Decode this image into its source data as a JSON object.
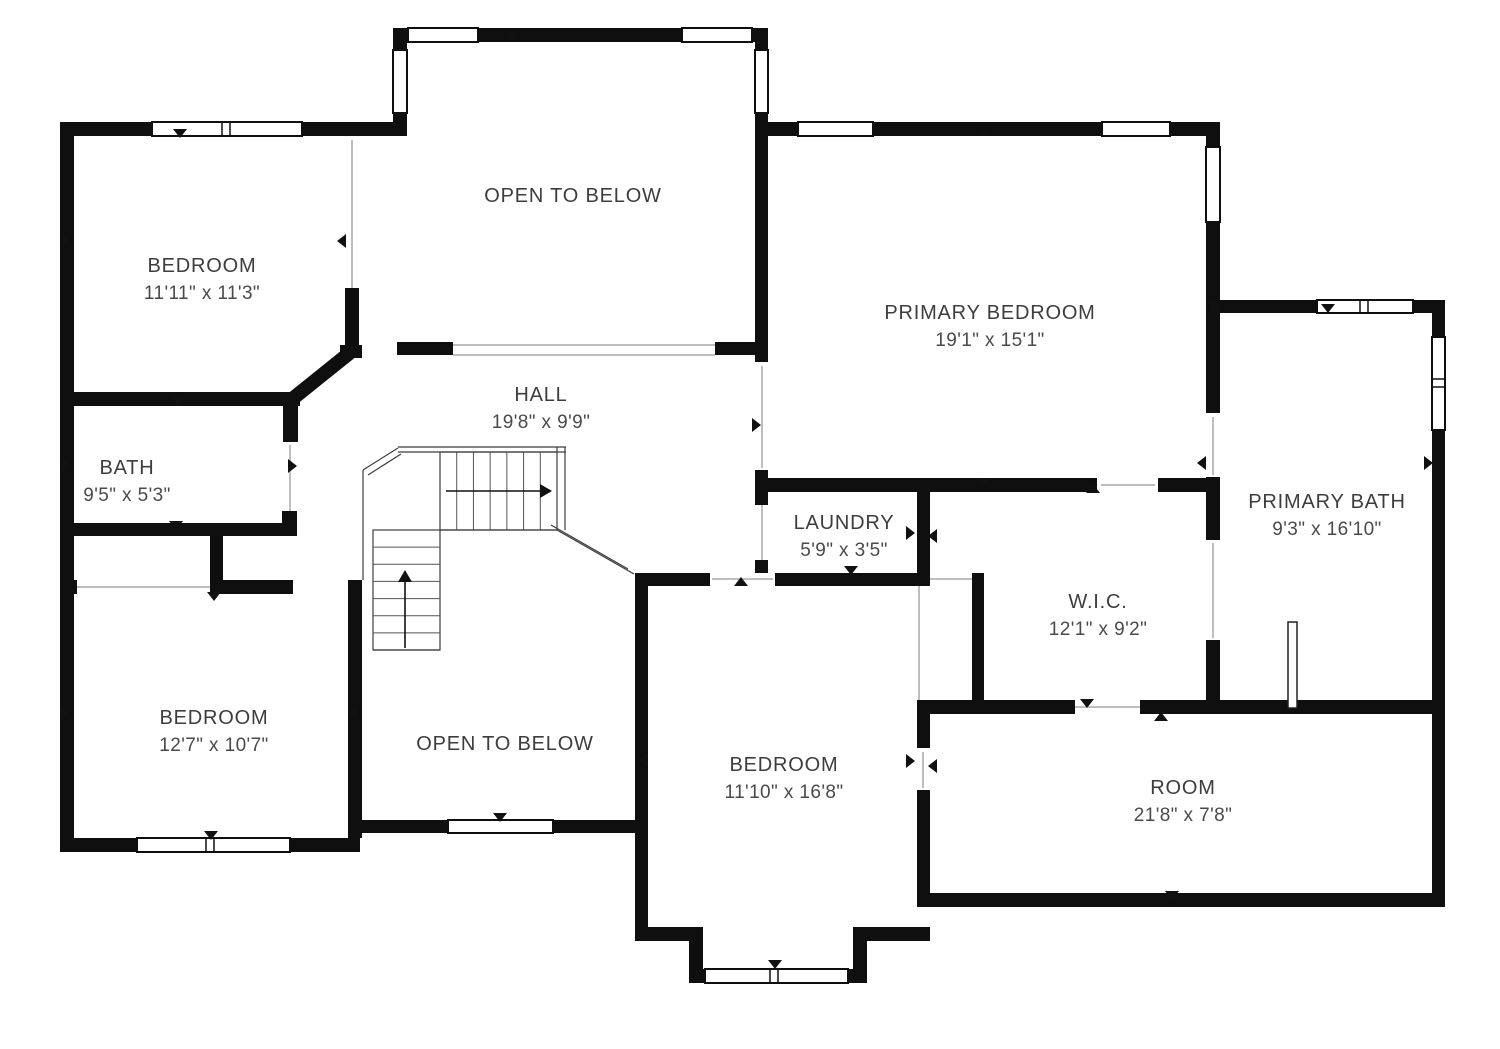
{
  "type": "floor-plan",
  "title": "Second floor plan",
  "colors": {
    "background": "#ffffff",
    "wall": "#0f0f0f",
    "opening_line": "#a8a8a8",
    "stair_line": "#3c3c3c",
    "tread_line": "#555555",
    "text": "#3d3d3d"
  },
  "canvas": {
    "width": 1500,
    "height": 1049
  },
  "rooms": [
    {
      "id": "bedroom-top-left",
      "name": "BEDROOM",
      "dims": "11'11\" x 11'3\"",
      "x": 202,
      "y": 272
    },
    {
      "id": "open-to-below-top",
      "name": "OPEN TO BELOW",
      "dims": "",
      "x": 573,
      "y": 202
    },
    {
      "id": "primary-bedroom",
      "name": "PRIMARY BEDROOM",
      "dims": "19'1\" x 15'1\"",
      "x": 990,
      "y": 319
    },
    {
      "id": "hall",
      "name": "HALL",
      "dims": "19'8\" x 9'9\"",
      "x": 541,
      "y": 401
    },
    {
      "id": "bath",
      "name": "BATH",
      "dims": "9'5\" x 5'3\"",
      "x": 127,
      "y": 474
    },
    {
      "id": "laundry",
      "name": "LAUNDRY",
      "dims": "5'9\" x 3'5\"",
      "x": 844,
      "y": 529
    },
    {
      "id": "primary-bath",
      "name": "PRIMARY BATH",
      "dims": "9'3\" x 16'10\"",
      "x": 1327,
      "y": 508
    },
    {
      "id": "wic",
      "name": "W.I.C.",
      "dims": "12'1\" x 9'2\"",
      "x": 1098,
      "y": 608
    },
    {
      "id": "bedroom-bottom-left",
      "name": "BEDROOM",
      "dims": "12'7\" x 10'7\"",
      "x": 214,
      "y": 724
    },
    {
      "id": "open-to-below-bottom",
      "name": "OPEN TO BELOW",
      "dims": "",
      "x": 505,
      "y": 750
    },
    {
      "id": "bedroom-bottom-middle",
      "name": "BEDROOM",
      "dims": "11'10\" x 16'8\"",
      "x": 784,
      "y": 771
    },
    {
      "id": "room-bonus",
      "name": "ROOM",
      "dims": "21'8\" x 7'8\"",
      "x": 1183,
      "y": 794
    }
  ],
  "walls": [
    [
      60,
      122,
      345,
      14
    ],
    [
      60,
      122,
      14,
      730
    ],
    [
      393,
      28,
      375,
      14
    ],
    [
      393,
      28,
      14,
      108
    ],
    [
      755,
      28,
      13,
      108
    ],
    [
      755,
      122,
      465,
      14
    ],
    [
      1206,
      122,
      14,
      192
    ],
    [
      1220,
      300,
      225,
      13
    ],
    [
      1432,
      300,
      13,
      607
    ],
    [
      345,
      288,
      14,
      70
    ],
    [
      340,
      345,
      22,
      13
    ],
    [
      397,
      342,
      56,
      13
    ],
    [
      715,
      342,
      53,
      13
    ],
    [
      755,
      136,
      13,
      226
    ],
    [
      755,
      470,
      13,
      22
    ],
    [
      755,
      478,
      342,
      14
    ],
    [
      1158,
      478,
      62,
      14
    ],
    [
      1206,
      300,
      14,
      113
    ],
    [
      1206,
      477,
      14,
      63
    ],
    [
      1206,
      640,
      14,
      74
    ],
    [
      917,
      700,
      158,
      14
    ],
    [
      1140,
      700,
      305,
      14
    ],
    [
      917,
      893,
      528,
      14
    ],
    [
      917,
      492,
      13,
      81
    ],
    [
      755,
      492,
      13,
      13
    ],
    [
      755,
      560,
      13,
      13
    ],
    [
      635,
      573,
      75,
      13
    ],
    [
      775,
      573,
      155,
      13
    ],
    [
      972,
      573,
      12,
      135
    ],
    [
      635,
      573,
      13,
      368
    ],
    [
      917,
      700,
      13,
      48
    ],
    [
      917,
      790,
      13,
      103
    ],
    [
      648,
      927,
      55,
      14
    ],
    [
      689,
      927,
      14,
      56
    ],
    [
      689,
      969,
      175,
      14
    ],
    [
      853,
      927,
      14,
      56
    ],
    [
      853,
      927,
      77,
      14
    ],
    [
      60,
      392,
      240,
      14
    ],
    [
      283,
      392,
      15,
      50
    ],
    [
      60,
      523,
      237,
      13
    ],
    [
      282,
      511,
      15,
      25
    ],
    [
      210,
      525,
      13,
      68
    ],
    [
      60,
      580,
      17,
      14
    ],
    [
      210,
      580,
      83,
      14
    ],
    [
      348,
      580,
      14,
      258
    ],
    [
      348,
      820,
      295,
      13
    ],
    [
      60,
      838,
      300,
      14
    ]
  ],
  "diagonal_walls": [
    {
      "x1": 352,
      "y1": 351,
      "x2": 291,
      "y2": 400,
      "w": 14
    }
  ],
  "windows": [
    {
      "x": 152,
      "y": 122,
      "w": 150,
      "h": 14,
      "o": "h",
      "m": [
        222,
        230
      ]
    },
    {
      "x": 408,
      "y": 28,
      "w": 70,
      "h": 14,
      "o": "h",
      "m": []
    },
    {
      "x": 682,
      "y": 28,
      "w": 70,
      "h": 14,
      "o": "h",
      "m": []
    },
    {
      "x": 393,
      "y": 50,
      "w": 14,
      "h": 63,
      "o": "v",
      "m": []
    },
    {
      "x": 755,
      "y": 50,
      "w": 13,
      "h": 63,
      "o": "v",
      "m": []
    },
    {
      "x": 798,
      "y": 122,
      "w": 75,
      "h": 14,
      "o": "h",
      "m": []
    },
    {
      "x": 1102,
      "y": 122,
      "w": 68,
      "h": 14,
      "o": "h",
      "m": []
    },
    {
      "x": 1206,
      "y": 147,
      "w": 14,
      "h": 75,
      "o": "v",
      "m": []
    },
    {
      "x": 1317,
      "y": 300,
      "w": 96,
      "h": 13,
      "o": "h",
      "m": [
        1360,
        1368
      ]
    },
    {
      "x": 1432,
      "y": 337,
      "w": 13,
      "h": 93,
      "o": "v",
      "m": [
        379,
        387
      ]
    },
    {
      "x": 448,
      "y": 820,
      "w": 105,
      "h": 13,
      "o": "h",
      "m": []
    },
    {
      "x": 705,
      "y": 969,
      "w": 143,
      "h": 14,
      "o": "h",
      "m": [
        770,
        778
      ]
    },
    {
      "x": 137,
      "y": 838,
      "w": 153,
      "h": 14,
      "o": "h",
      "m": [
        206,
        214
      ]
    }
  ],
  "openings": [
    [
      352,
      140,
      352,
      288
    ],
    [
      77,
      587,
      210,
      587
    ],
    [
      453,
      345,
      715,
      345
    ],
    [
      453,
      355,
      715,
      355
    ],
    [
      762,
      366,
      762,
      468
    ],
    [
      762,
      505,
      762,
      560
    ],
    [
      1213,
      417,
      1213,
      475
    ],
    [
      1213,
      543,
      1213,
      638
    ],
    [
      919,
      586,
      919,
      700
    ],
    [
      1075,
      707,
      1140,
      707
    ],
    [
      1101,
      485,
      1155,
      485
    ],
    [
      930,
      579,
      972,
      579
    ],
    [
      923,
      752,
      923,
      788
    ],
    [
      290,
      445,
      290,
      520
    ],
    [
      712,
      579,
      773,
      579
    ]
  ],
  "arrows": [
    {
      "x": 180,
      "y": 134,
      "dir": "down"
    },
    {
      "x": 67,
      "y": 240,
      "dir": "right"
    },
    {
      "x": 341,
      "y": 241,
      "dir": "left"
    },
    {
      "x": 511,
      "y": 38,
      "dir": "down"
    },
    {
      "x": 985,
      "y": 131,
      "dir": "up"
    },
    {
      "x": 1216,
      "y": 307,
      "dir": "right"
    },
    {
      "x": 1201,
      "y": 463,
      "dir": "left"
    },
    {
      "x": 1429,
      "y": 463,
      "dir": "right"
    },
    {
      "x": 757,
      "y": 425,
      "dir": "right"
    },
    {
      "x": 178,
      "y": 401,
      "dir": "down"
    },
    {
      "x": 176,
      "y": 526,
      "dir": "down"
    },
    {
      "x": 67,
      "y": 465,
      "dir": "right"
    },
    {
      "x": 293,
      "y": 466,
      "dir": "right"
    },
    {
      "x": 214,
      "y": 597,
      "dir": "down"
    },
    {
      "x": 65,
      "y": 713,
      "dir": "right"
    },
    {
      "x": 352,
      "y": 713,
      "dir": "left"
    },
    {
      "x": 211,
      "y": 836,
      "dir": "down"
    },
    {
      "x": 500,
      "y": 818,
      "dir": "down"
    },
    {
      "x": 775,
      "y": 965,
      "dir": "down"
    },
    {
      "x": 741,
      "y": 581,
      "dir": "up"
    },
    {
      "x": 851,
      "y": 571,
      "dir": "down"
    },
    {
      "x": 911,
      "y": 533,
      "dir": "right"
    },
    {
      "x": 932,
      "y": 536,
      "dir": "left"
    },
    {
      "x": 911,
      "y": 761,
      "dir": "right"
    },
    {
      "x": 932,
      "y": 766,
      "dir": "left"
    },
    {
      "x": 983,
      "y": 484,
      "dir": "down"
    },
    {
      "x": 1093,
      "y": 488,
      "dir": "up"
    },
    {
      "x": 1087,
      "y": 704,
      "dir": "down"
    },
    {
      "x": 1161,
      "y": 716,
      "dir": "up"
    },
    {
      "x": 1328,
      "y": 309,
      "dir": "down"
    },
    {
      "x": 1172,
      "y": 896,
      "dir": "down"
    },
    {
      "x": 643,
      "y": 760,
      "dir": "left"
    }
  ],
  "stairs": {
    "upper_flight": {
      "x0": 440,
      "y0": 452,
      "x1": 557,
      "y1": 530,
      "treads": 6
    },
    "lower_flight": {
      "x0": 373,
      "y0": 530,
      "x1": 440,
      "y1": 650,
      "treads": 6
    },
    "rail_lines": [
      [
        363,
        470,
        363,
        580
      ],
      [
        363,
        470,
        398,
        448
      ],
      [
        368,
        475,
        401,
        454
      ],
      [
        398,
        447,
        566,
        447
      ],
      [
        398,
        452,
        566,
        452
      ],
      [
        557,
        447,
        557,
        452
      ],
      [
        565,
        447,
        565,
        530
      ],
      [
        440,
        530,
        557,
        530
      ],
      [
        557,
        530,
        634,
        574
      ],
      [
        551,
        525,
        628,
        569
      ],
      [
        373,
        650,
        440,
        650
      ]
    ],
    "up_arrow": {
      "stem": [
        405,
        648,
        405,
        580
      ],
      "tip": [
        405,
        570
      ]
    },
    "right_arrow": {
      "stem": [
        446,
        491,
        540,
        491
      ],
      "tip": [
        552,
        491
      ]
    }
  },
  "fixtures": {
    "shower_glass": {
      "x": 1288,
      "y": 622,
      "w": 9,
      "h": 86
    }
  }
}
